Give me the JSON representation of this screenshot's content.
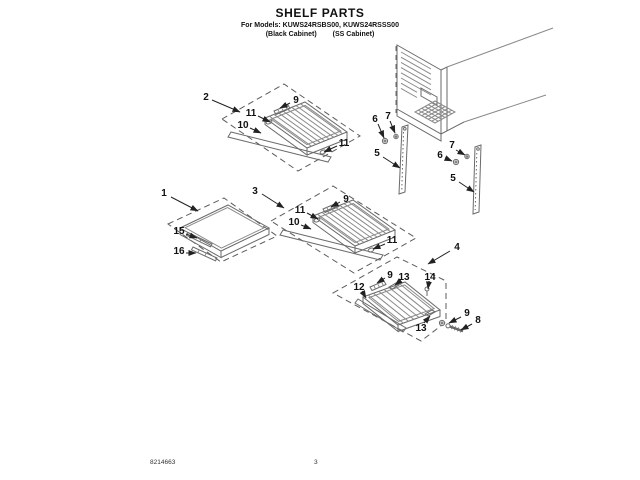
{
  "header": {
    "title": "SHELF PARTS",
    "models": "For Models: KUWS24RSBS00, KUWS24RSSS00",
    "cabinet_black": "(Black Cabinet)",
    "cabinet_ss": "(SS Cabinet)"
  },
  "footer": {
    "doc_number": "8214663",
    "page_number": "3"
  },
  "callouts": {
    "n1": "1",
    "n2": "2",
    "n3": "3",
    "n4": "4",
    "n5": "5",
    "n6": "6",
    "n7": "7",
    "n8": "8",
    "n9": "9",
    "n10": "10",
    "n11": "11",
    "n12": "12",
    "n13": "13",
    "n14": "14",
    "n15": "15",
    "n16": "16"
  },
  "diagram_colors": {
    "part_line": "#6a6a6a",
    "wire_line": "#8a8a8a",
    "dashed_line": "#5c5c5c",
    "arrow_line": "#222222"
  }
}
